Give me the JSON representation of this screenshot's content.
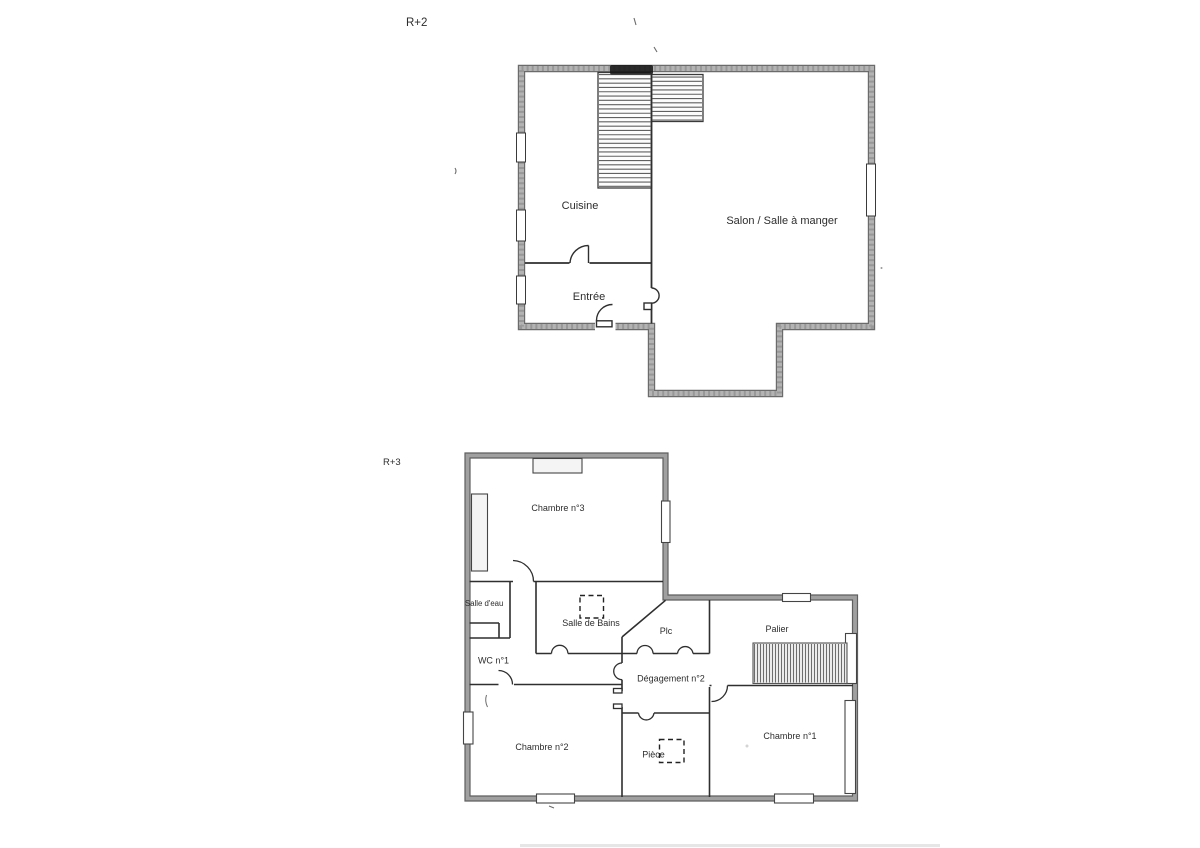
{
  "document": {
    "kind": "scanned floor plan",
    "background": "#ffffff"
  },
  "floors": [
    {
      "label": "R+2",
      "rooms": [
        {
          "name": "Cuisine"
        },
        {
          "name": "Salon / Salle à manger"
        },
        {
          "name": "Entrée"
        }
      ],
      "has_stairs": true,
      "stair_flights": 2
    },
    {
      "label": "R+3",
      "rooms": [
        {
          "name": "Chambre n°3"
        },
        {
          "name": "Salle d'eau"
        },
        {
          "name": "Salle de Bains"
        },
        {
          "name": "Plc"
        },
        {
          "name": "Palier"
        },
        {
          "name": "WC n°1"
        },
        {
          "name": "Dégagement n°2"
        },
        {
          "name": "Chambre n°2"
        },
        {
          "name": "Pièce"
        },
        {
          "name": "Chambre n°1"
        }
      ],
      "has_stairs": true,
      "stair_flights": 1
    }
  ],
  "colors": {
    "outer_wall_core": "#b0b0b0",
    "outer_wall_edge": "#666666",
    "interior_line": "#2f2f2f",
    "stair_hatch": "#6d6d6d",
    "text": "#2d2d2d",
    "background": "#ffffff"
  }
}
